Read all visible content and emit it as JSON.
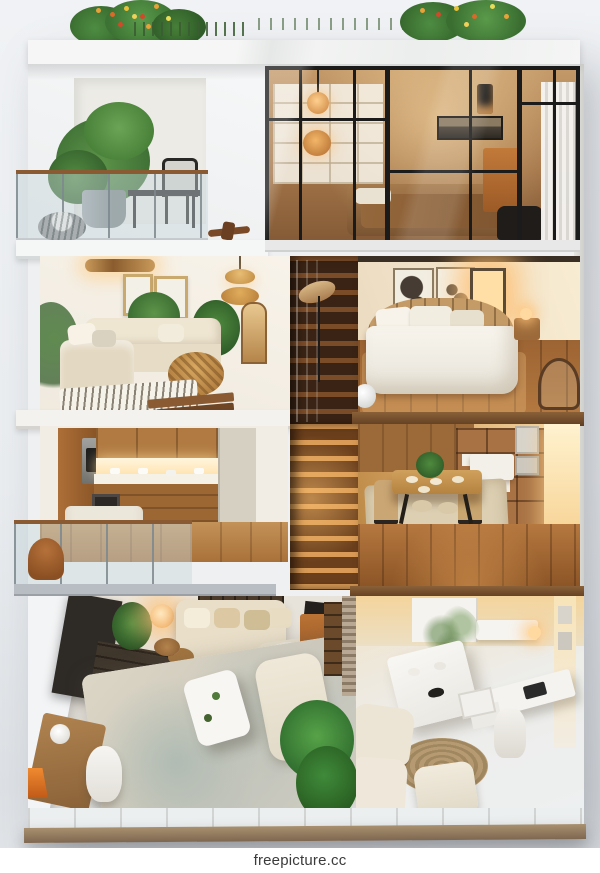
{
  "watermark": {
    "text": "freepicture.cc"
  },
  "scene": {
    "kind": "isometric-cutaway-dollhouse-render",
    "description": "3D cutaway render of a four-storey modern apartment building with warm interior lighting, white exterior walls, rooftop plants and a central wooden staircase",
    "floors": [
      {
        "name": "roof",
        "items": [
          "flowering-shrub-left",
          "flowering-shrub-right",
          "grass-tufts",
          "white-marble-ledge"
        ]
      },
      {
        "name": "top-floor",
        "rooms": [
          {
            "name": "open-balcony",
            "items": [
              "potted-fern",
              "metal-desk",
              "metal-chair",
              "glass-railing-wood-handrail",
              "decorative-bowl",
              "wooden-airplane-decor"
            ]
          },
          {
            "name": "glass-walled-bedroom",
            "items": [
              "black-frame-window-grid",
              "white-shelving",
              "pendant-lamps",
              "landscape-picture",
              "bed-brown-blanket",
              "orange-cabinet",
              "dark-armchair",
              "white-curtain"
            ]
          }
        ]
      },
      {
        "name": "third-floor",
        "rooms": [
          {
            "name": "living-room",
            "items": [
              "ceiling-light",
              "two-gold-framed-pictures",
              "wicker-pendant-lamps",
              "l-shaped-beige-sofa",
              "corner-plants",
              "rattan-coffee-table",
              "striped-rug",
              "wood-boards"
            ]
          },
          {
            "name": "stairwell",
            "items": [
              "dark-wood-stairs"
            ]
          },
          {
            "name": "bedroom",
            "items": [
              "two-abstract-art-frames",
              "glowing-wall-sconce",
              "floor-lamp",
              "wood-headboard-bed-white-duvet",
              "nightstands",
              "wicker-chair",
              "dark-wood-floor"
            ]
          }
        ]
      },
      {
        "name": "second-floor",
        "rooms": [
          {
            "name": "kitchen",
            "items": [
              "built-in-oven",
              "wood-cabinets",
              "under-cabinet-glow",
              "white-counter",
              "dark-framed-picture",
              "white-table",
              "glass-balcony-railing",
              "brown-chair"
            ]
          },
          {
            "name": "stairwell",
            "items": [
              "lit-wooden-stairs"
            ]
          },
          {
            "name": "dining-room",
            "items": [
              "wood-panel-wall",
              "shelf-unit-with-boxes",
              "oak-dining-table",
              "plant-centerpiece",
              "black-leg-chairs",
              "cream-rug",
              "warm-wall-glow",
              "wood-floor"
            ]
          }
        ]
      },
      {
        "name": "ground-floor",
        "rooms": [
          {
            "name": "family-living-room",
            "items": [
              "tv-panel",
              "media-console",
              "wine-shelf",
              "beige-sofa-with-pillows",
              "glowing-table-lamp",
              "white-coffee-table",
              "large-rug-teal-patches",
              "cream-chaise",
              "blanket-armchair",
              "orange-cabinet-with-art",
              "big-green-plant",
              "wood-desk",
              "orange-desk-lamp",
              "white-shell-chair"
            ]
          },
          {
            "name": "home-office-lounge",
            "items": [
              "brick-divider-column",
              "white-dining-table",
              "branch-centerpiece",
              "white-desk-with-laptop",
              "white-desk-chair",
              "nesting-side-tables",
              "two-cream-armchairs",
              "cream-ottoman",
              "round-jute-rug",
              "kitchenette-counter"
            ]
          }
        ]
      }
    ]
  },
  "colors": {
    "background": "#eef0f3",
    "exterior_wall_white": "#f3f4f6",
    "roof_marble": "#f1f3f2",
    "window_frame_black": "#1b1b1b",
    "warm_glow": "#ffd9a0",
    "wood_dark": "#5a3a22",
    "wood_mid": "#8a5a33",
    "wood_light": "#c08a4e",
    "sofa_beige": "#e9dfc9",
    "bedding_white": "#f4f1ea",
    "cabinet_orange": "#b06a2f",
    "plant_green": "#4e8c42",
    "tile_gray": "#e3e6e8",
    "watermark_text": "#3b3b3b"
  }
}
